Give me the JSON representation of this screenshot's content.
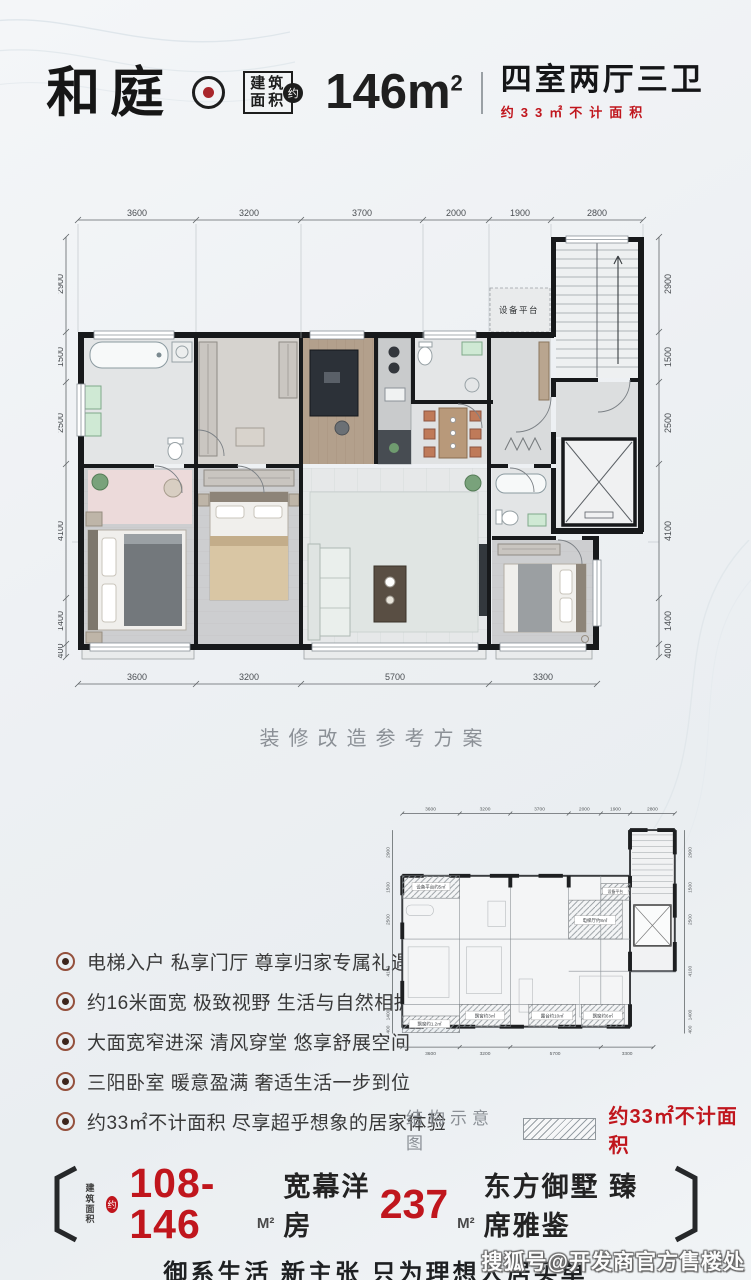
{
  "colors": {
    "accent": "#c0161d",
    "ink": "#1b1b1b",
    "muted": "#8b9096"
  },
  "header": {
    "project_name": "和庭",
    "area_box_line1": "建筑",
    "area_box_line2": "面积",
    "approx_badge": "约",
    "area_value": "146",
    "area_unit": "m",
    "area_sup": "2",
    "rooms_title": "四室两厅三卫",
    "area_note": "约33㎡不计面积"
  },
  "dims": {
    "top": [
      "3600",
      "3200",
      "3700",
      "2000",
      "1900",
      "2800"
    ],
    "bottom": [
      "3600",
      "3200",
      "5700",
      "3300"
    ],
    "side": [
      "2900",
      "1500",
      "2500",
      "4100",
      "1400",
      "400"
    ]
  },
  "main_plan": {
    "caption": "装修改造参考方案",
    "equipment_label": "设备平台"
  },
  "features": {
    "items": [
      "电梯入户 私享门厅 尊享归家专属礼遇",
      "约16米面宽 极致视野 生活与自然相拥",
      "大面宽窄进深 清风穿堂 悠享舒展空间",
      "三阳卧室 暖意盈满 奢适生活一步到位",
      "约33㎡不计面积 尽享超乎想象的居家体验"
    ]
  },
  "structure_plan": {
    "caption": "结构示意图",
    "legend_text": "约33㎡不计面积",
    "labels": {
      "equipment": "设备平台约5㎡",
      "equipment_small": "设备平台",
      "elevator_hall": "电梯厅约8㎡",
      "bay_window_a": "飘窗约1.2㎡",
      "bay_window_b": "飘窗约3㎡",
      "terrace": "露台约10㎡",
      "bay_window_c": "飘窗约6㎡"
    }
  },
  "banner": {
    "area_box_line1": "建筑",
    "area_box_line2": "面积",
    "approx_badge": "约",
    "range": "108-146",
    "range_unit": "M²",
    "type1": "宽幕洋房",
    "value2": "237",
    "value2_unit": "M²",
    "type2": "东方御墅 臻席雅鉴",
    "slogan": "御系生活 新主张 只为理想人居买单"
  },
  "watermark": "搜狐号@开发商官方售楼处"
}
